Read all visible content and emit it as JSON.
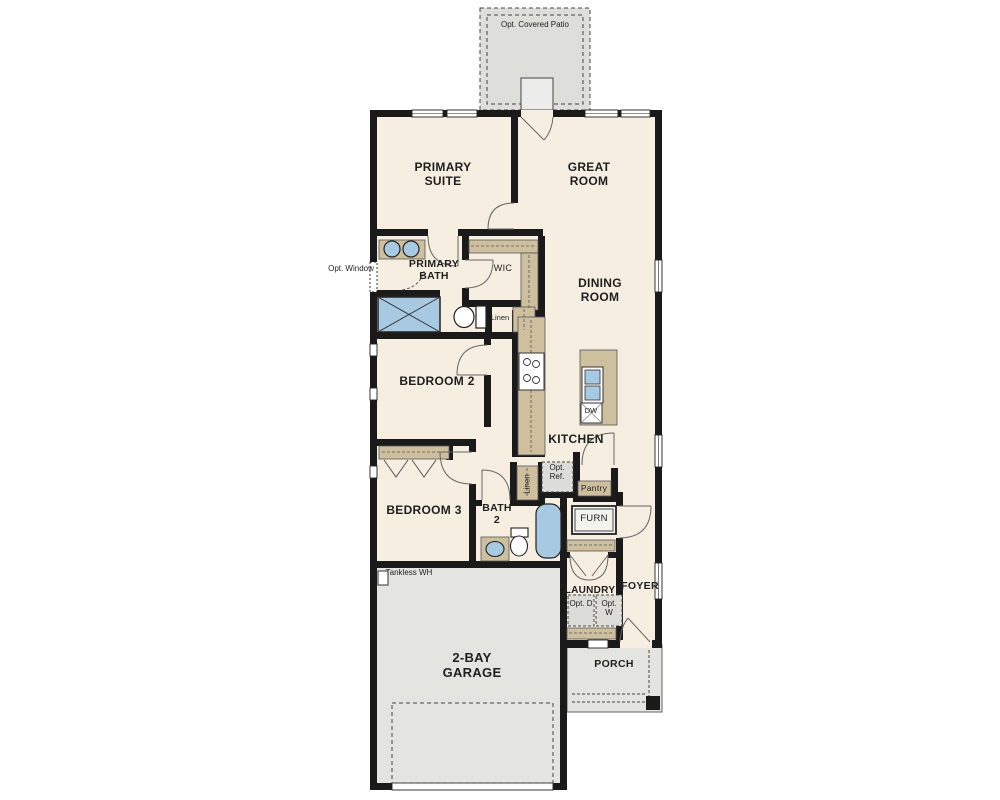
{
  "colors": {
    "floor": "#f6eee1",
    "outdoor": "#e4e4e1",
    "patio": "#dededa",
    "wall": "#1a1a1a",
    "counter": "#cec09f",
    "fixture_blue": "#a8c9e2",
    "appliance_gray": "#dcdcd8",
    "text": "#1f1f1f"
  },
  "labels": {
    "patio": "Opt. Covered Patio",
    "primary_suite": "PRIMARY SUITE",
    "great_room": "GREAT ROOM",
    "primary_bath": "PRIMARY BATH",
    "wic": "WIC",
    "opt_window": "Opt. Window",
    "dining_room": "DINING ROOM",
    "linen_bath1": "Linen",
    "bedroom_2": "BEDROOM 2",
    "kitchen": "KITCHEN",
    "opt_ref": "Opt. Ref.",
    "linen_bath2": "Linen",
    "pantry": "Pantry",
    "bedroom_3": "BEDROOM 3",
    "bath_2": "BATH 2",
    "furnace": "FURN",
    "dishwasher": "DW",
    "tankless_wh": "Tankless WH",
    "laundry": "LAUNDRY",
    "opt_dryer": "Opt. D",
    "opt_washer": "Opt. W",
    "foyer": "FOYER",
    "garage": "2-BAY GARAGE",
    "porch": "PORCH"
  }
}
